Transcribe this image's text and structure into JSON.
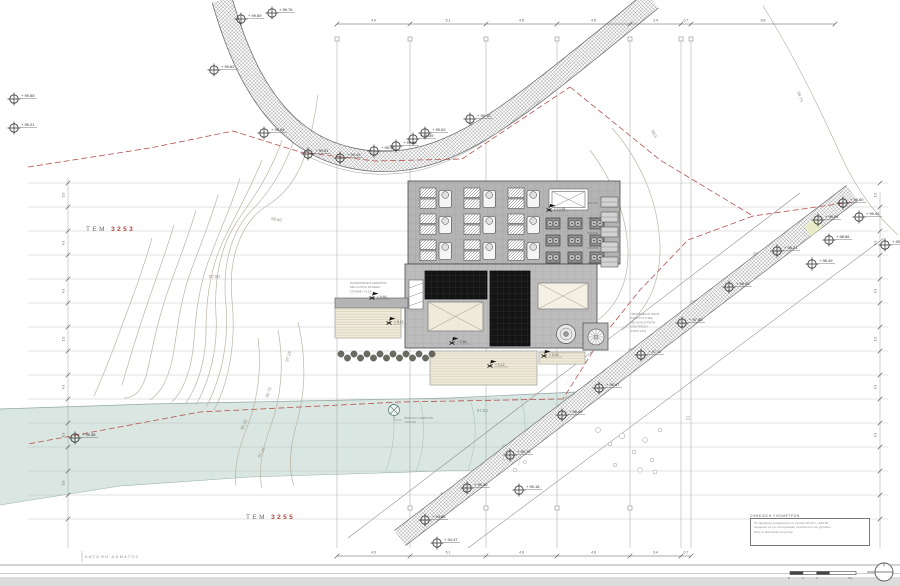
{
  "drawing": {
    "plan_label": "ΚΑΤΟΨΗ ΔΩΜΑΤΟΣ",
    "parcel_north": {
      "prefix": "ΤΕΜ",
      "number": "3253"
    },
    "parcel_south": {
      "prefix": "ΤΕΜ",
      "number": "3255"
    }
  },
  "notes_box": {
    "title": "ΣΗΜΕΙΩΣΗ ΥΨΟΜΕΤΡΩΝ",
    "lines": [
      "Τα υψόμετρα αναφέρονται σε σχετικό ±0.00 = +100.00",
      "σύμφωνα με την τοπογραφική αποτύπωση του γηπέδου.",
      "Όλες οι διαστάσεις σε μέτρα."
    ]
  },
  "scale_bar": {
    "labels": [
      "0",
      "1",
      "2",
      "5m"
    ]
  },
  "annotations": {
    "terrace_note": [
      "ΔΙΑΜΟΡΦΩΣΗ ΔΩΜΑΤΟΣ",
      "ΜΕ ΞΥΛΙΝΟ ΔΑΠΕΔΟ",
      "ΣΤΑΘΜΗ +9.66"
    ],
    "road_note": [
      "ΥΦΙΣΤΑΜΕΝΗ ΟΔΟΣ",
      "ΠΛΑΤΟΥΣ 5.00μ",
      "ΜΕ ΛΙΘΟΣΤΡΩΤΗ",
      "ΕΠΙΣΤΡΩΣΗ",
      "ΚΛΙΣΗ 12%"
    ],
    "well_label": [
      "ΦΡΕΑΤΙΟ ΟΜΒΡΙΩΝ",
      "ΥΔΑΤΩΝ"
    ]
  },
  "contour_labels": [
    [
      "99.75",
      797,
      92,
      72
    ],
    [
      "99.5",
      651,
      131,
      62
    ],
    [
      "98.60",
      271,
      220,
      8
    ],
    [
      "97.50",
      209,
      278,
      0
    ],
    [
      "97.25",
      288,
      362,
      -72
    ],
    [
      "96.75",
      268,
      398,
      -70
    ],
    [
      "96.25",
      243,
      430,
      -66
    ],
    [
      "97.25",
      260,
      458,
      -60
    ],
    [
      "97.50",
      477,
      412,
      0
    ]
  ],
  "spot_elevations": [
    [
      241,
      19,
      "+ 99.89"
    ],
    [
      272,
      13,
      "+ 99.76"
    ],
    [
      214,
      70,
      "+ 99.62"
    ],
    [
      14,
      99,
      "+ 99.55"
    ],
    [
      14,
      128,
      "+ 99.21"
    ],
    [
      264,
      133,
      "+ 99.04"
    ],
    [
      308,
      154,
      "+ 99.51"
    ],
    [
      340,
      158,
      "+ 99.43"
    ],
    [
      374,
      151,
      "+ 99.48"
    ],
    [
      396,
      146,
      "+ 99.28"
    ],
    [
      413,
      139,
      "+ 99.39"
    ],
    [
      425,
      133,
      "+ 99.02"
    ],
    [
      470,
      119,
      "+ 99.15"
    ],
    [
      843,
      203,
      "+ 99.60"
    ],
    [
      859,
      217,
      "+ 99.42"
    ],
    [
      818,
      220,
      "+ 98.94"
    ],
    [
      829,
      240,
      "+ 98.66"
    ],
    [
      885,
      245,
      "+ 99.21"
    ],
    [
      812,
      264,
      "+ 98.49"
    ],
    [
      777,
      251,
      "+ 98.21"
    ],
    [
      729,
      287,
      "+ 98.03"
    ],
    [
      682,
      323,
      "+ 97.58"
    ],
    [
      641,
      355,
      "+ 97.12"
    ],
    [
      599,
      388,
      "+ 96.67"
    ],
    [
      562,
      415,
      "+ 96.43"
    ],
    [
      510,
      455,
      "+ 95.76"
    ],
    [
      467,
      488,
      "+ 95.30"
    ],
    [
      425,
      520,
      "+ 94.85"
    ],
    [
      437,
      543,
      "+ 94.47"
    ],
    [
      75,
      438,
      "+ 95.58"
    ],
    [
      519,
      490,
      "+ 95.18"
    ]
  ],
  "flag_points": [
    [
      549,
      210,
      "+ 10.48"
    ],
    [
      372,
      298,
      "+ 9.66"
    ],
    [
      389,
      323,
      "+ 9.12"
    ],
    [
      452,
      343,
      "+ 9.66"
    ],
    [
      490,
      366,
      "+ 9.12"
    ],
    [
      544,
      356,
      "+ 9.40"
    ]
  ],
  "roof_units": {
    "fan_coil_labels": [
      "FCU 01",
      "FCU 02",
      "FCU 03",
      "FCU 04",
      "FCU 05"
    ]
  },
  "dimensions": {
    "top_ticks": [
      337,
      410,
      486,
      557,
      630,
      681,
      691,
      835
    ],
    "top_values": [
      "4.9",
      "5.1",
      "4.8",
      "4.8",
      "3.4",
      "0.7",
      "9.6"
    ],
    "bottom_ticks": [
      337,
      410,
      486,
      557,
      630,
      681,
      691
    ],
    "bottom_values": [
      "4.9",
      "5.1",
      "4.8",
      "4.8",
      "3.4",
      "0.7"
    ],
    "left_values": [
      "0.9",
      "4.9",
      "4.9",
      "1.0",
      "4.9",
      "4.9",
      "0.9"
    ],
    "right_values": [
      "1.0",
      "4.9",
      "4.9",
      "1.0",
      "4.9",
      "4.9"
    ]
  },
  "colors": {
    "parcel_number_red": "#b5423c",
    "boundary_red": "#b5534e",
    "river_fill": "#d9e6e2",
    "roof_gray": "#b4b4b4",
    "pv_dark": "#141414",
    "terrace_cream": "#efeadb"
  }
}
